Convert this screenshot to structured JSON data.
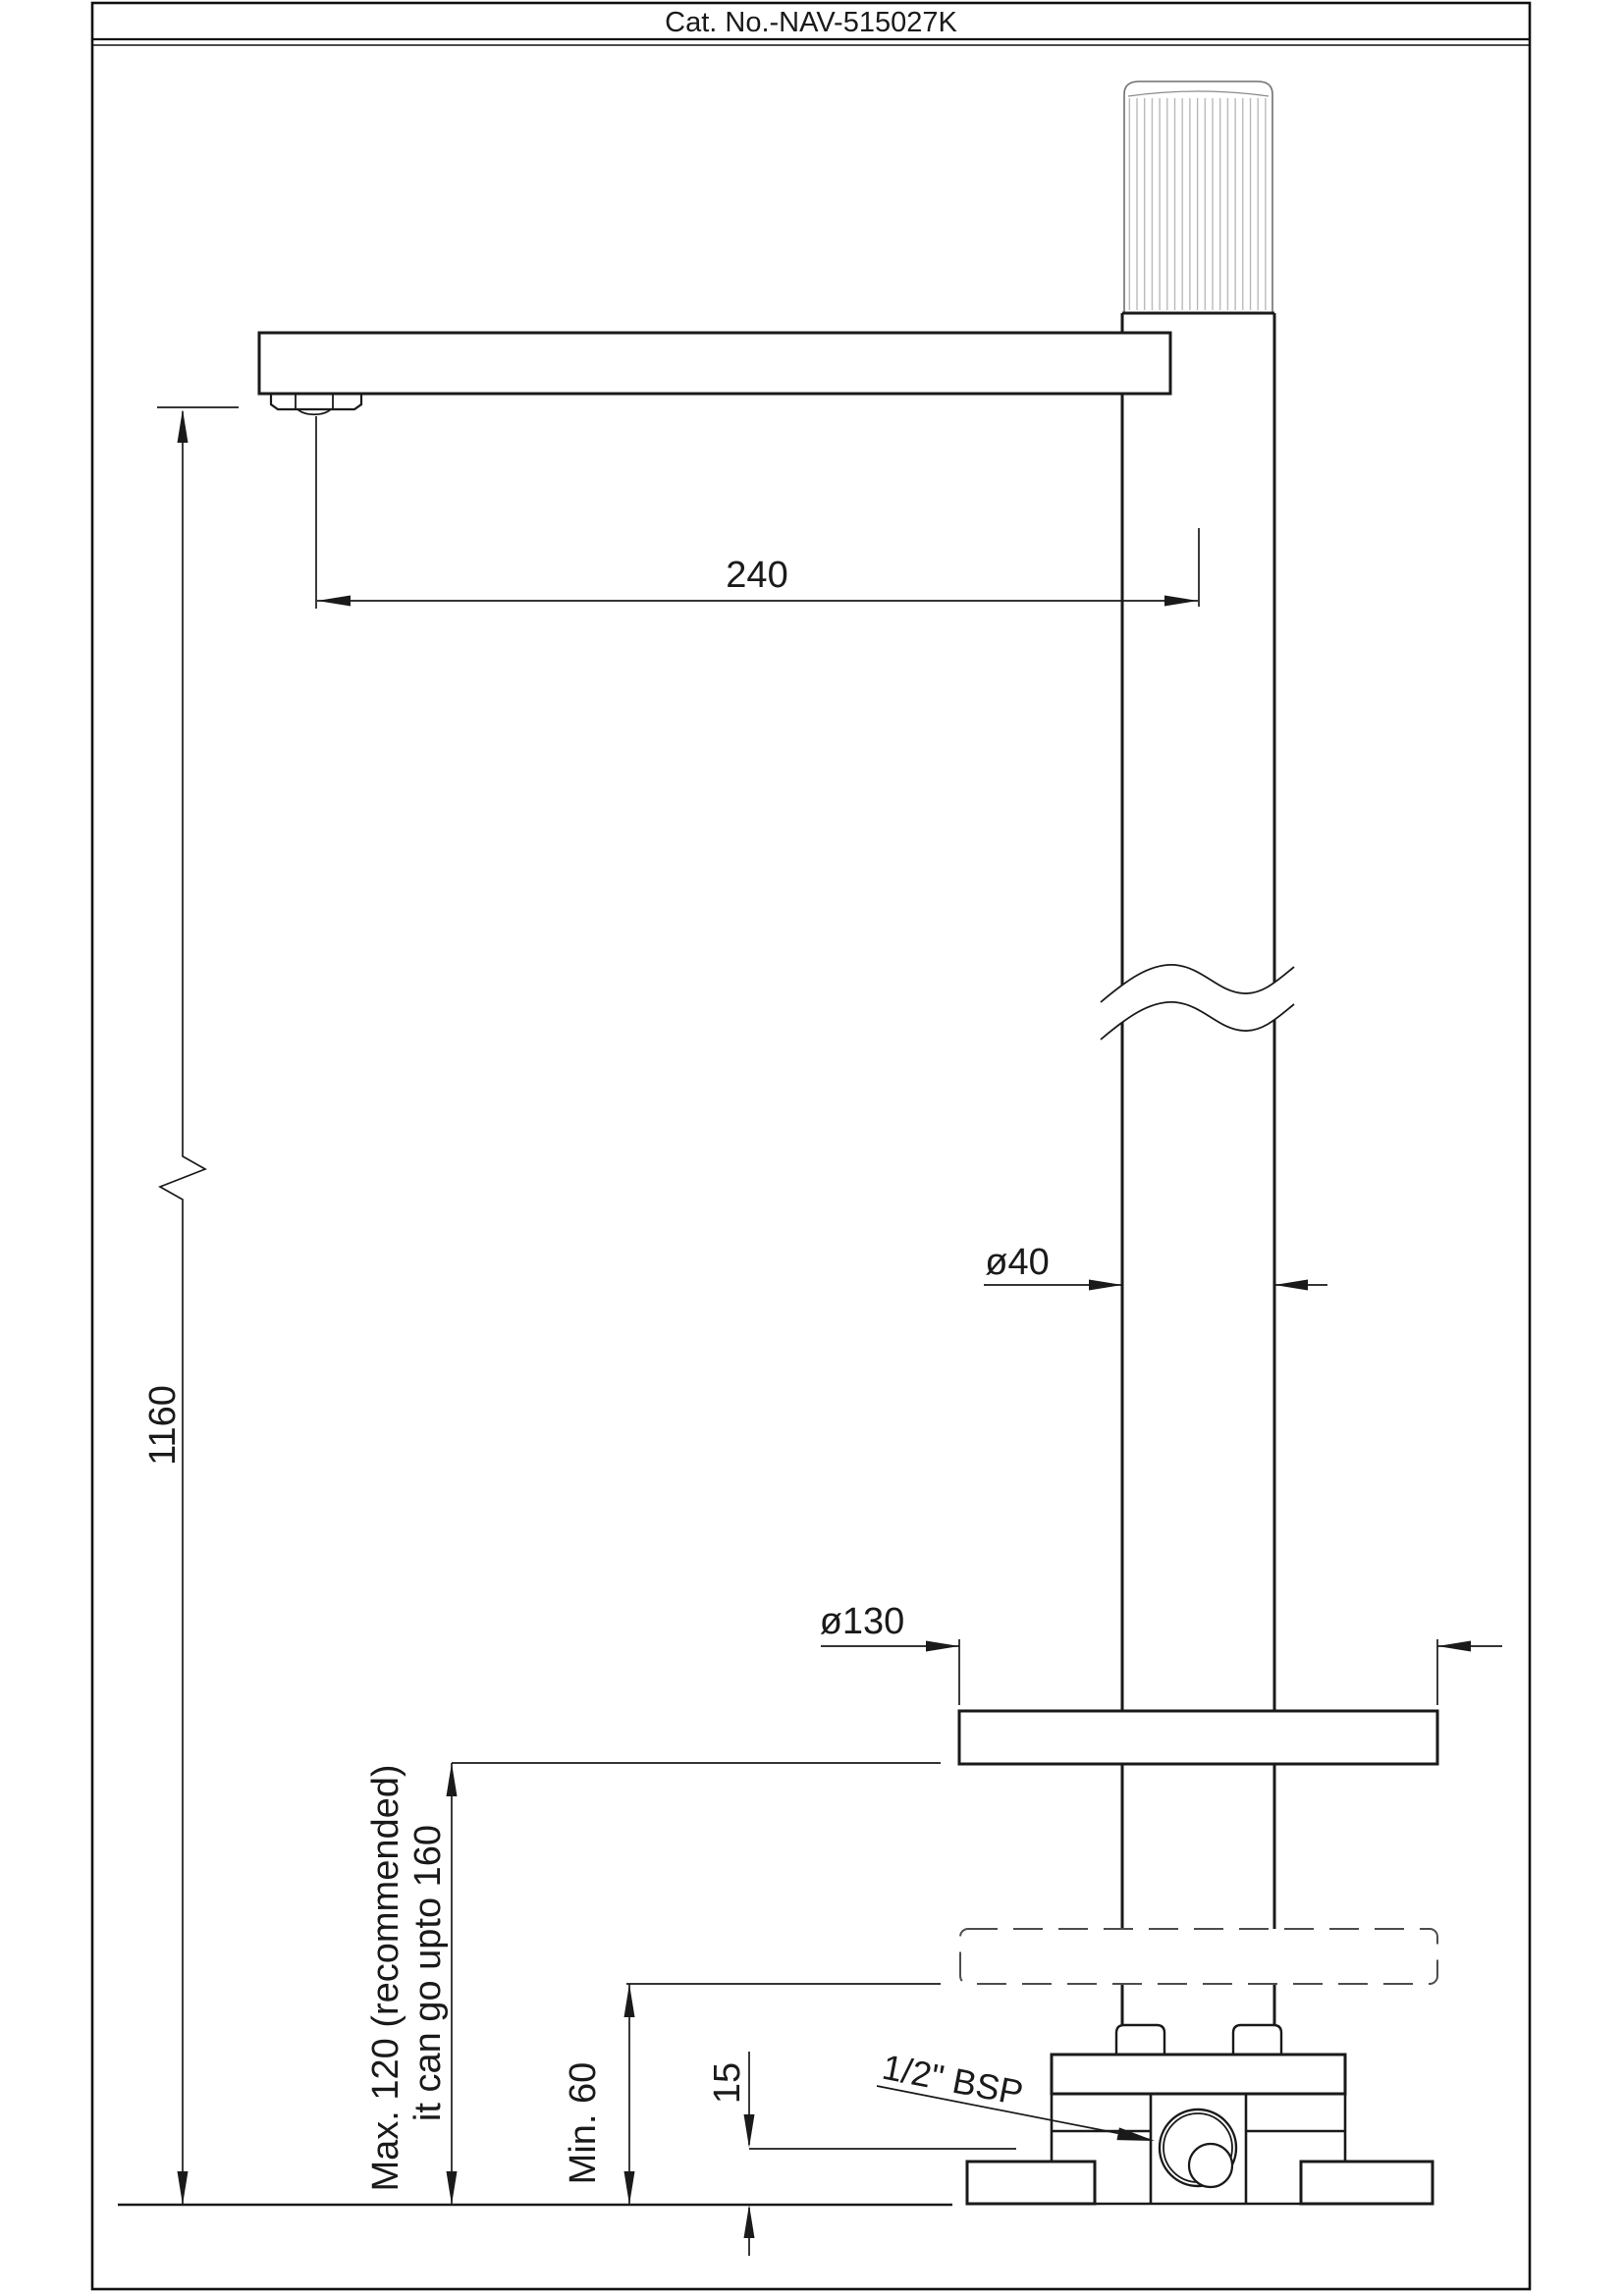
{
  "title_bar": {
    "label": "Cat. No.-NAV-515027K"
  },
  "drawing": {
    "labels": {
      "spout_reach": "240",
      "overall_height": "1160",
      "pipe_diameter": "ø40",
      "flange_diameter": "ø130",
      "deck_max_line1": "Max. 120 (recommended)",
      "deck_max_line2": "it can go upto 160",
      "deck_min": "Min. 60",
      "floor_step": "15",
      "inlet_thread": "1/2\" BSP"
    }
  }
}
